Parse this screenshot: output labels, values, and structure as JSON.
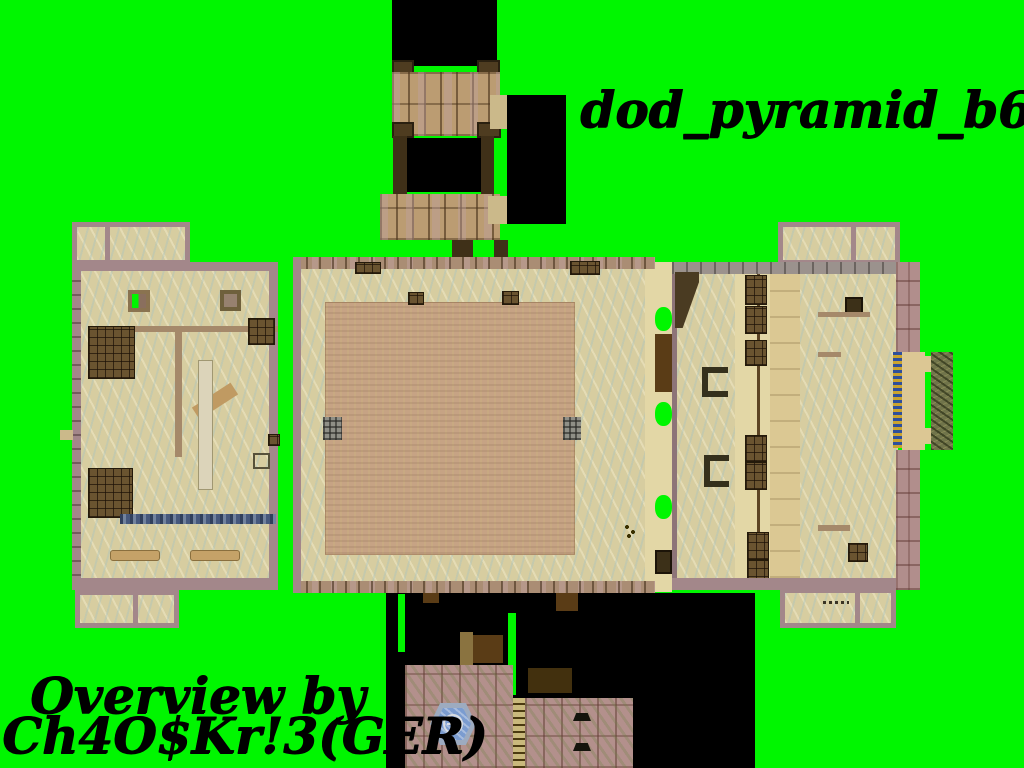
{
  "title": "dod_pyramid_b6",
  "credit": {
    "line1": "Overview by",
    "line2": "Ch4O$Kr!3(GER)"
  },
  "icons": {
    "fountain": "circle-cross-emblem"
  },
  "colors": {
    "chroma_green": "#00f600",
    "shadow_black": "#000000",
    "sand": "#d7cda0",
    "pyramid_top": "#c6a384",
    "border_mauve": "#a3878a",
    "brick_pink": "#b18e8c",
    "crate_brown": "#6a5430",
    "grass": "#70744a",
    "fountain_blue": "#7b9cd0",
    "stairs_blue": "#46587c",
    "ladder_yellow": "#caa42e"
  }
}
